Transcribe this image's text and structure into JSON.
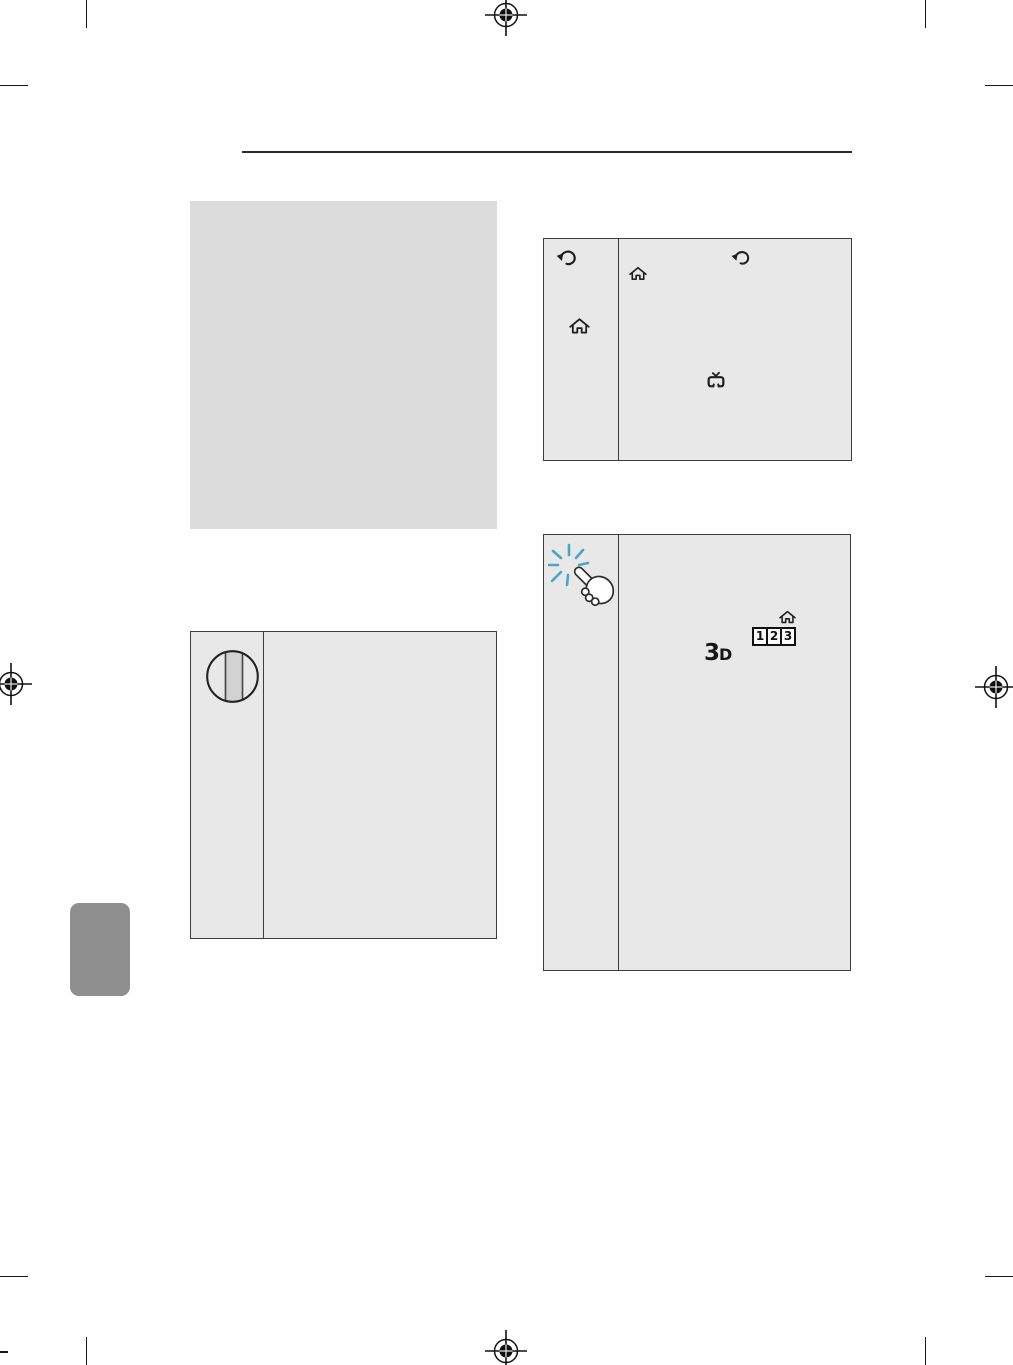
{
  "page": {
    "kind": "printed-manual-page",
    "background": "#ffffff",
    "width_px": 1013,
    "height_px": 1365
  },
  "colors": {
    "panel_plain_fill": "#dcdcdc",
    "panel_fill": "#e8e8e8",
    "panel_border": "#3d3d3d",
    "rule": "#2b2b2b",
    "language_tab_fill": "#8f8f8f",
    "icon_stroke": "#1f1f1f",
    "pointer_sparkle_blue": "#4aa6c9",
    "wheel_band_fill": "#d2d2d2"
  },
  "print_marks": {
    "registration_marks": [
      "top-center",
      "left-middle",
      "right-middle",
      "bottom-center"
    ],
    "trim_marks": [
      "top-left",
      "top-right",
      "bottom-left",
      "bottom-right"
    ]
  },
  "sections": {
    "top_rule": true,
    "placeholder_block": {
      "text": ""
    },
    "remote_panel": {
      "left_column_icons": [
        "back-icon",
        "home-icon"
      ],
      "body_icons": [
        "home-icon",
        "back-icon",
        "tv-icon"
      ]
    },
    "wheel_panel": {
      "left_column_icons": [
        "wheel-button-icon"
      ],
      "body_text": ""
    },
    "magic_remote_panel": {
      "left_column_icons": [
        "magic-pointer-hand-icon"
      ],
      "body_icons": [
        "home-icon",
        "numbers-123-icon",
        "3d-icon"
      ],
      "numbers_icon_digits": [
        "1",
        "2",
        "3"
      ],
      "three_d_label": {
        "three": "3",
        "d": "D"
      }
    },
    "language_tab": {
      "text": ""
    }
  }
}
